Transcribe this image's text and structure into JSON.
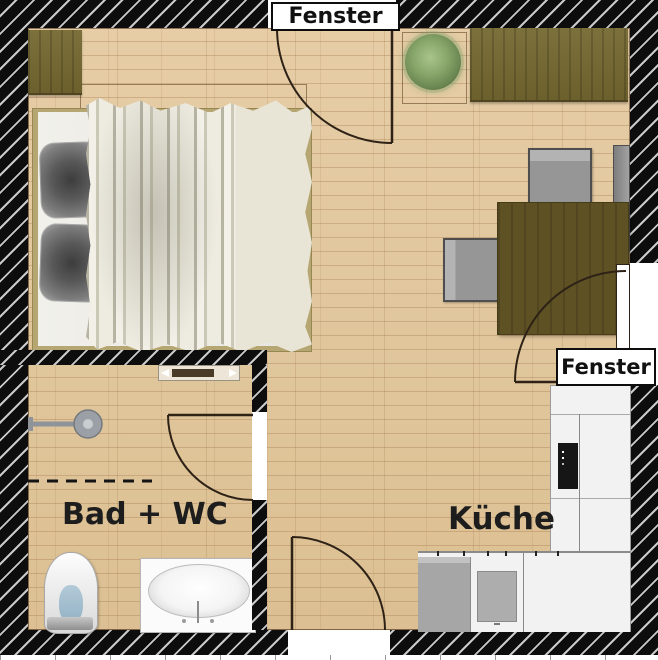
{
  "plan": {
    "type": "apartment-floor-plan",
    "windows": [
      {
        "id": "window-top",
        "label": "Fenster"
      },
      {
        "id": "window-right",
        "label": "Fenster"
      }
    ],
    "rooms": [
      {
        "id": "bathroom",
        "label": "Bad + WC"
      },
      {
        "id": "kitchen",
        "label": "Küche"
      }
    ],
    "doors": [
      "entrance-door-bottom",
      "bathroom-door"
    ],
    "furniture": [
      "dresser",
      "double-bed",
      "pillow",
      "pillow",
      "blanket",
      "potted-plant",
      "wardrobe",
      "dining-table",
      "chair-north",
      "chair-west",
      "chair-east",
      "radiator",
      "shower",
      "shower-partition-dashed",
      "toilet",
      "washbasin-counter",
      "kitchen-counter-right",
      "oven",
      "kitchen-counter-bottom",
      "dishwasher",
      "cooktop"
    ],
    "colors": {
      "wall": "#0d0d0d",
      "wall_hatch": "#c9c9c9",
      "floor": "#e2c79e",
      "floor_seam": "#966a3c",
      "wood_furniture": "#756931",
      "table": "#5e5224",
      "chair": "#969696",
      "blanket": "#e8e5d7",
      "pillow": "#585858",
      "plant": "#86a569",
      "counter": "#f2f2f2",
      "appliance": "#a6a6a6",
      "oven": "#161616",
      "label_text": "#111111"
    }
  }
}
